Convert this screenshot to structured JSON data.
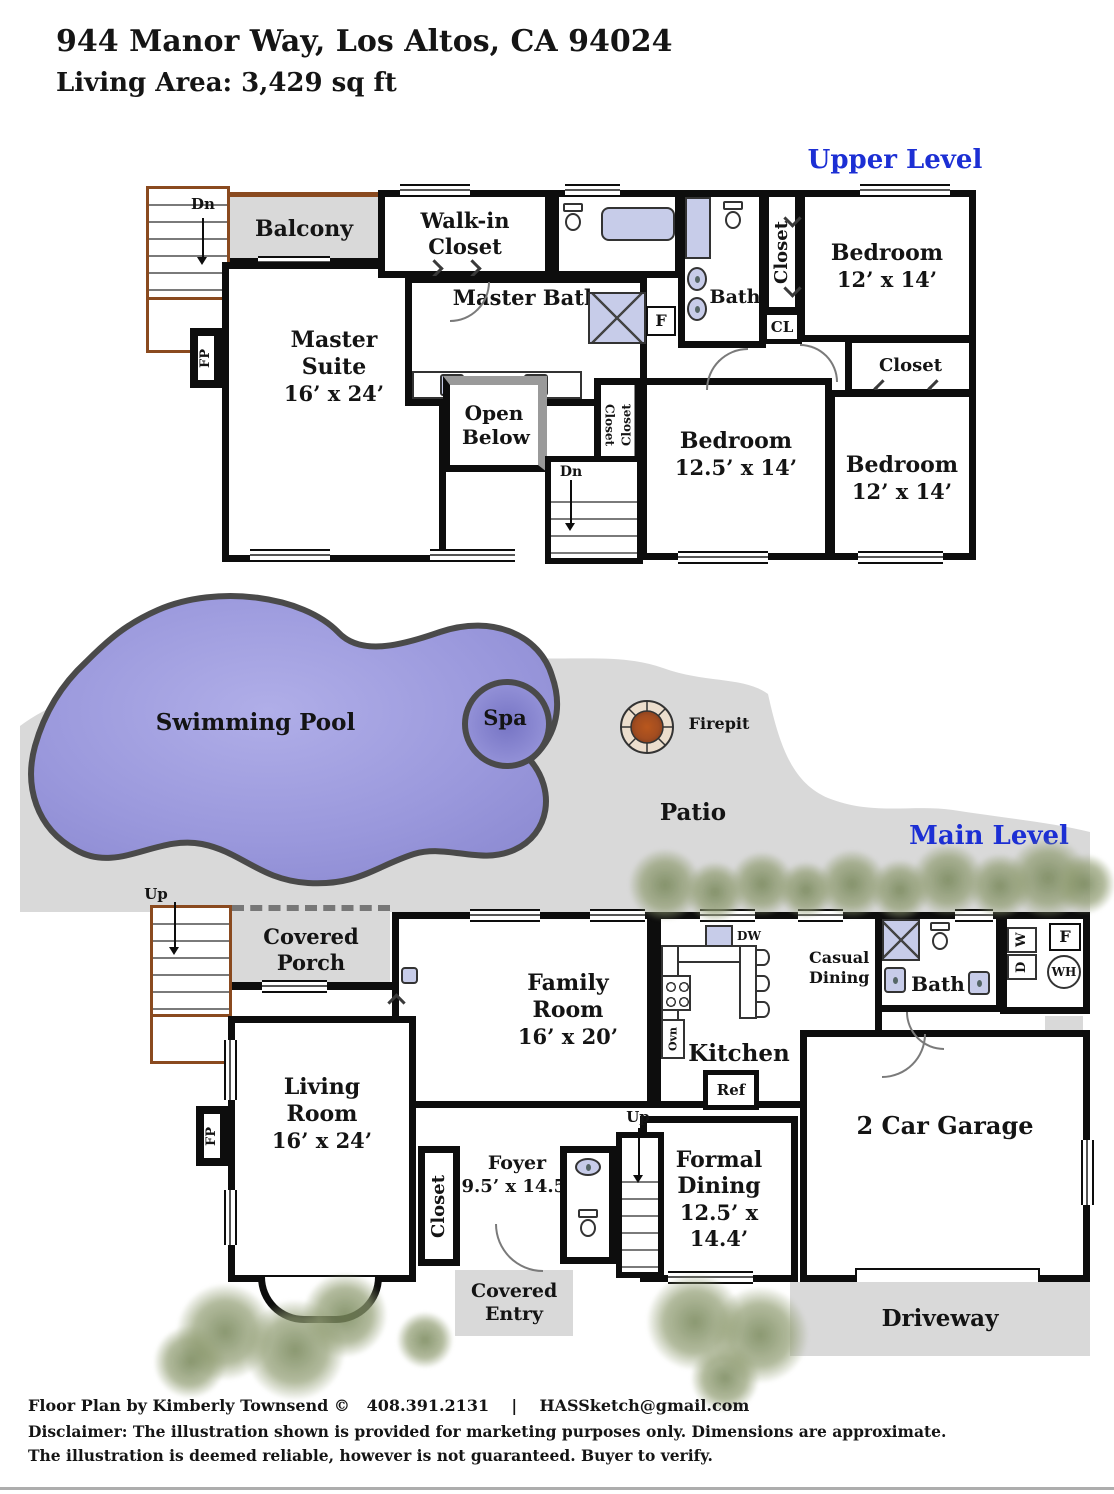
{
  "header": {
    "address": "944 Manor Way, Los Altos, CA 94024",
    "living_area": "Living Area: 3,429 sq ft"
  },
  "levels": {
    "upper": "Upper Level",
    "main": "Main Level"
  },
  "colors": {
    "accent_blue": "#1c2fd4",
    "pool_fill": "#9a98dc",
    "patio_gray": "#d9d9d9",
    "fixture_lavender": "#c7cce9",
    "wall_black": "#0d0d0d",
    "stair_trim_brown": "#8a4a1f"
  },
  "upper": {
    "dn_exterior": "Dn",
    "balcony": "Balcony",
    "walk_in_closet": "Walk-in Closet",
    "master_bath": "Master Bath",
    "hall_bath": "Bath",
    "furnace": "F",
    "fireplace": "FP",
    "closet_hall": "Closet",
    "cl": "CL",
    "bedroom_top_right": {
      "name": "Bedroom",
      "dims": "12’ x 14’"
    },
    "closet_top_right": "Closet",
    "master_suite": {
      "name": "Master Suite",
      "dims": "16’ x 24’"
    },
    "open_below": "Open Below",
    "closet_mid_a": "Closet",
    "closet_mid_b": "Closet",
    "dn_interior": "Dn",
    "bedroom_middle": {
      "name": "Bedroom",
      "dims": "12.5’ x 14’"
    },
    "bedroom_bottom_right": {
      "name": "Bedroom",
      "dims": "12’ x 14’"
    }
  },
  "outdoor": {
    "swimming_pool": "Swimming Pool",
    "spa": "Spa",
    "firepit": "Firepit",
    "patio": "Patio",
    "up_exterior": "Up"
  },
  "main": {
    "covered_porch": "Covered Porch",
    "family_room": {
      "name": "Family Room",
      "dims": "16’ x 20’"
    },
    "kitchen": "Kitchen",
    "dw": "DW",
    "ovn": "Ovn",
    "ref": "Ref",
    "casual_dining": "Casual Dining",
    "bath": "Bath",
    "washer": "W",
    "dryer": "D",
    "furnace": "F",
    "water_heater": "WH",
    "living_room": {
      "name": "Living Room",
      "dims": "16’ x 24’"
    },
    "fireplace": "FP",
    "closet": "Closet",
    "foyer": {
      "name": "Foyer",
      "dims": "9.5’ x 14.5’"
    },
    "up_interior": "Up",
    "formal_dining": {
      "name": "Formal Dining",
      "dims": "12.5’ x 14.4’"
    },
    "garage": "2 Car Garage",
    "covered_entry": "Covered Entry",
    "driveway": "Driveway"
  },
  "footer": {
    "credit": "Floor Plan by Kimberly Townsend ©   408.391.2131    |    HASSketch@gmail.com",
    "disclaimer1": "Disclaimer: The illustration shown is provided for marketing purposes only. Dimensions are approximate.",
    "disclaimer2": "The illustration is deemed reliable, however is not guaranteed. Buyer to verify."
  }
}
